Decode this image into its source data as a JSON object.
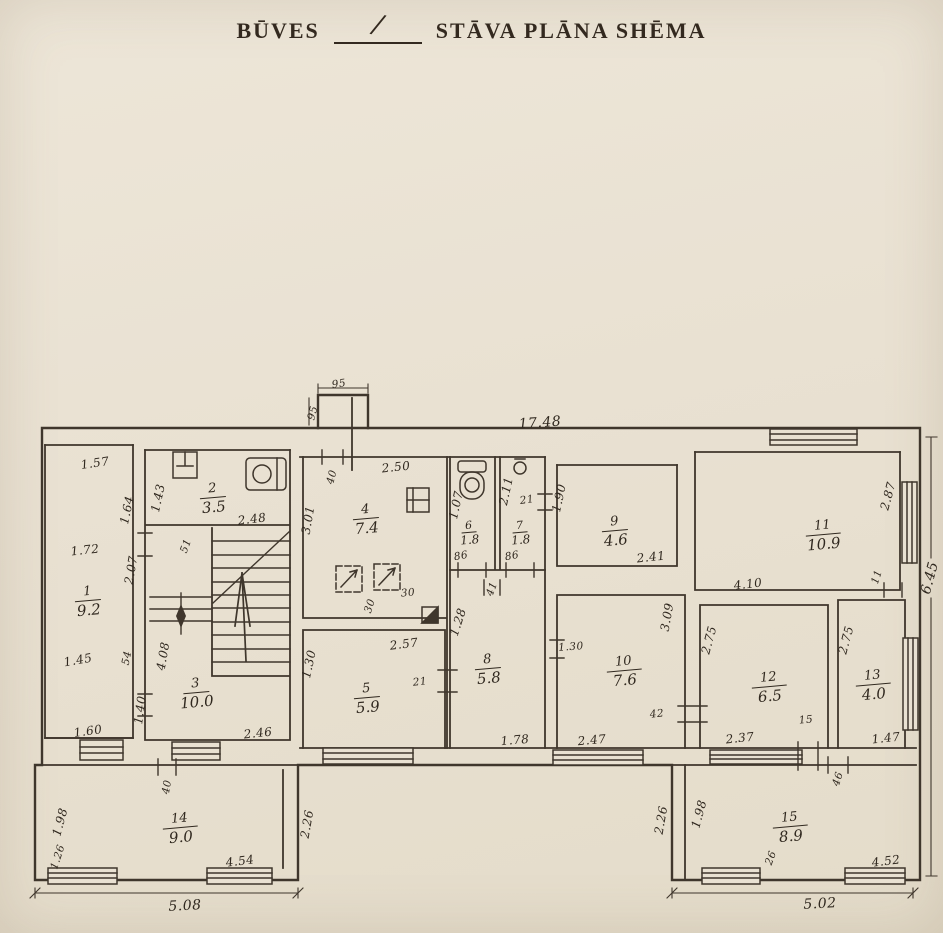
{
  "title": {
    "word1": "BŪVES",
    "blank": "/",
    "word2": "STĀVA PLĀNA SHĒMA"
  },
  "rooms": [
    {
      "number": "1",
      "area": "9.2"
    },
    {
      "number": "2",
      "area": "3.5"
    },
    {
      "number": "3",
      "area": "10.0"
    },
    {
      "number": "4",
      "area": "7.4"
    },
    {
      "number": "5",
      "area": "5.9"
    },
    {
      "number": "6",
      "area": "1.8"
    },
    {
      "number": "7",
      "area": "1.8"
    },
    {
      "number": "8",
      "area": "5.8"
    },
    {
      "number": "9",
      "area": "4.6"
    },
    {
      "number": "10",
      "area": "7.6"
    },
    {
      "number": "11",
      "area": "10.9"
    },
    {
      "number": "12",
      "area": "6.5"
    },
    {
      "number": "13",
      "area": "4.0"
    },
    {
      "number": "14",
      "area": "9.0"
    },
    {
      "number": "15",
      "area": "8.9"
    }
  ],
  "dims": {
    "chimney_top": "95",
    "chimney_side": "95",
    "overall_top": "17.48",
    "overall_right": "6.45",
    "r1_top": "1.57",
    "r1_right_u": "1.64",
    "r1_mid": "1.72",
    "r1_right_m": "2.07",
    "r1_mid2": "1.45",
    "r1_notch": "54",
    "r1_right_l": "1.40",
    "r1_bottom": "1.60",
    "r2_left": "1.43",
    "r2_bottom": "2.48",
    "stair_door": "51",
    "r3_left": "4.08",
    "r3_bottom": "2.46",
    "r4_door": "40",
    "r4_top": "2.50",
    "r4_left": "3.01",
    "r4_flue1": "30",
    "r4_flue2": "30",
    "r5_top": "2.57",
    "r5_left": "1.30",
    "r5_door": "21",
    "r6_left": "1.07",
    "r6_door": "86",
    "r7_left": "2.11",
    "r7_top": "21",
    "r7_door": "86",
    "hall_door": "41",
    "r8_left": "1.28",
    "r8_bottom": "1.78",
    "r9_left": "1.90",
    "r9_bottom": "2.41",
    "r10_top": "1.30",
    "r10_left": "3.09",
    "r10_bottom": "2.47",
    "r10_door": "42",
    "r11_bottom": "4.10",
    "r11_right": "2.87",
    "r11_door": "11",
    "r12_left": "2.75",
    "r12_bottom": "2.37",
    "r12_door": "15",
    "r13_left": "2.75",
    "r13_bottom": "1.47",
    "r14_door": "40",
    "r14_left": "1.98",
    "r14_win": "1.26",
    "r14_bottom": "4.54",
    "r14_overall": "5.08",
    "r14_right": "2.26",
    "r15_conn": "2.26",
    "r15_left": "1.98",
    "r15_door": "46",
    "r15_win": "26",
    "r15_bottom": "4.52",
    "r15_overall": "5.02"
  }
}
